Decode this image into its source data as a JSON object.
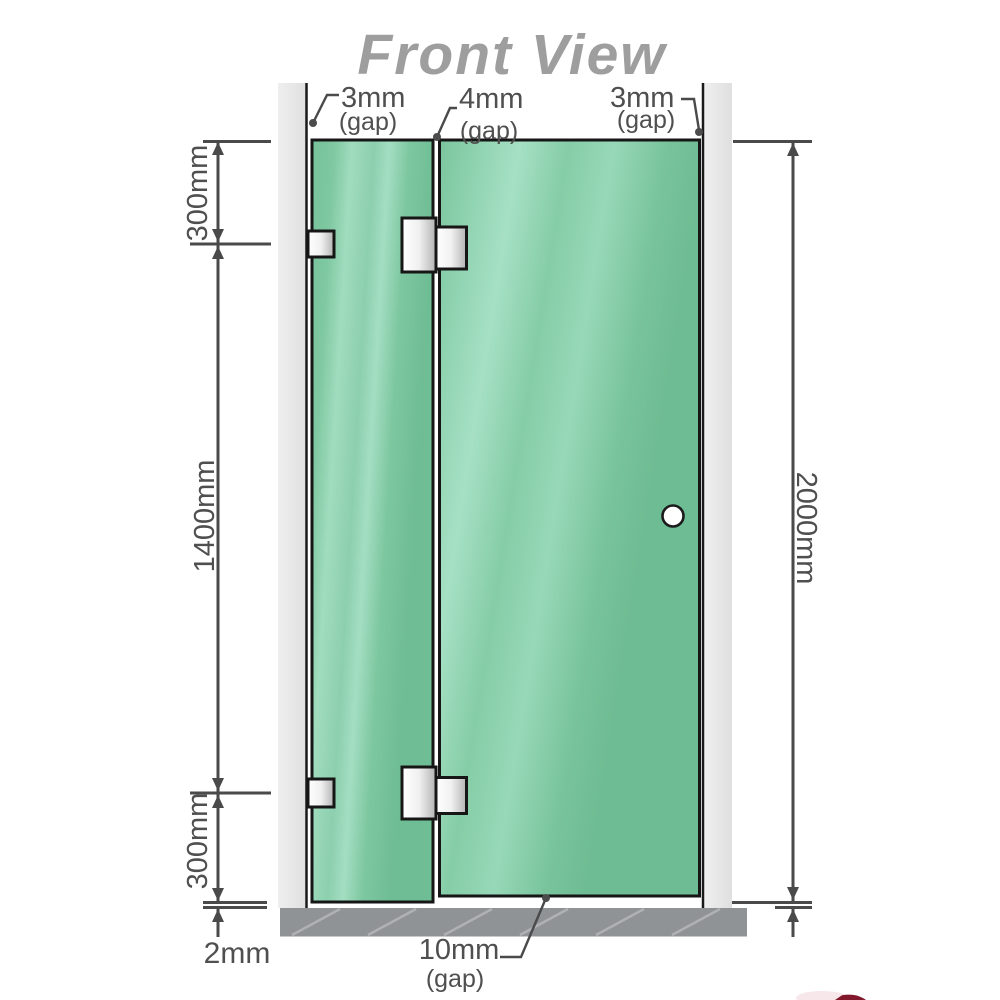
{
  "title": "Front View",
  "annotations": {
    "gap_top_left": {
      "value": "3mm",
      "qualifier": "(gap)"
    },
    "gap_top_middle": {
      "value": "4mm",
      "qualifier": "(gap)"
    },
    "gap_top_right": {
      "value": "3mm",
      "qualifier": "(gap)"
    },
    "gap_bottom": {
      "value": "10mm",
      "qualifier": "(gap)"
    },
    "floor_clearance": {
      "value": "2mm"
    }
  },
  "dimensions": {
    "left_top": "300mm",
    "left_middle": "1400mm",
    "left_bottom": "300mm",
    "right_overall": "2000mm"
  },
  "parts": [
    "left wall",
    "right wall",
    "fixed glass panel",
    "hinged glass door",
    "glass-to-glass hinge top",
    "glass-to-glass hinge bottom",
    "wall bracket top",
    "wall bracket bottom",
    "door knob",
    "floor"
  ],
  "colors": {
    "glass_green": "#84cba6",
    "glass_highlight": "#a6dfc3",
    "wall_gray": "#e8e8e8",
    "floor_gray": "#909396",
    "line_dark": "#4a4a4a",
    "text_gray": "#4f4f4f",
    "title_gray": "#9e9e9e",
    "hardware_metal": "#e9e9e9",
    "corner_mark_red": "#7b0c20"
  }
}
